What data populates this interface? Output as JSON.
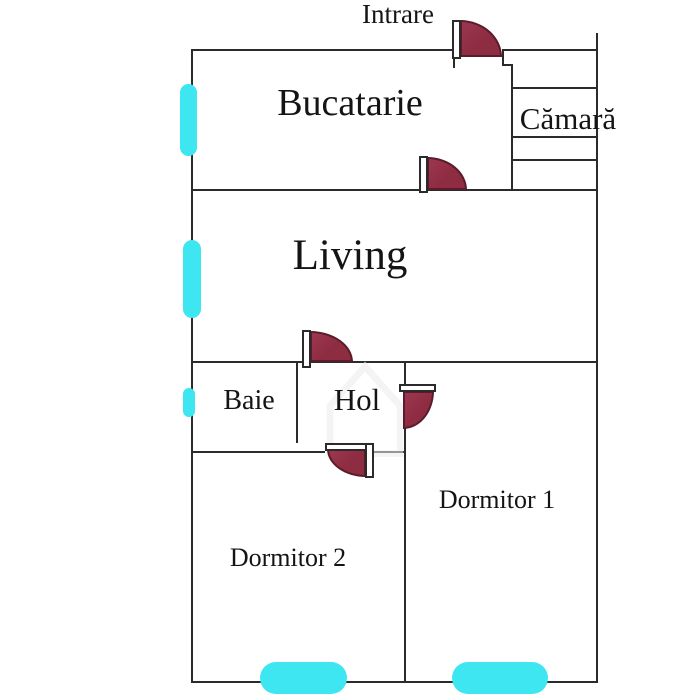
{
  "labels": {
    "entrance": "Intrare",
    "kitchen": "Bucatarie",
    "pantry": "Cămară",
    "living": "Living",
    "bathroom": "Baie",
    "hallway": "Hol",
    "bedroom1": "Dormitor 1",
    "bedroom2": "Dormitor 2"
  },
  "colors": {
    "wall": "#2b2b2b",
    "door_fill": "#8e2c42",
    "door_light": "#9c3750",
    "door_edge": "#5a1b2a",
    "window": "#3de6f1",
    "text": "#141414",
    "watermark": "#ececec"
  },
  "legend": {
    "window_marker": "cyan-window-marker",
    "door_marker": "maroon-door-swing"
  }
}
